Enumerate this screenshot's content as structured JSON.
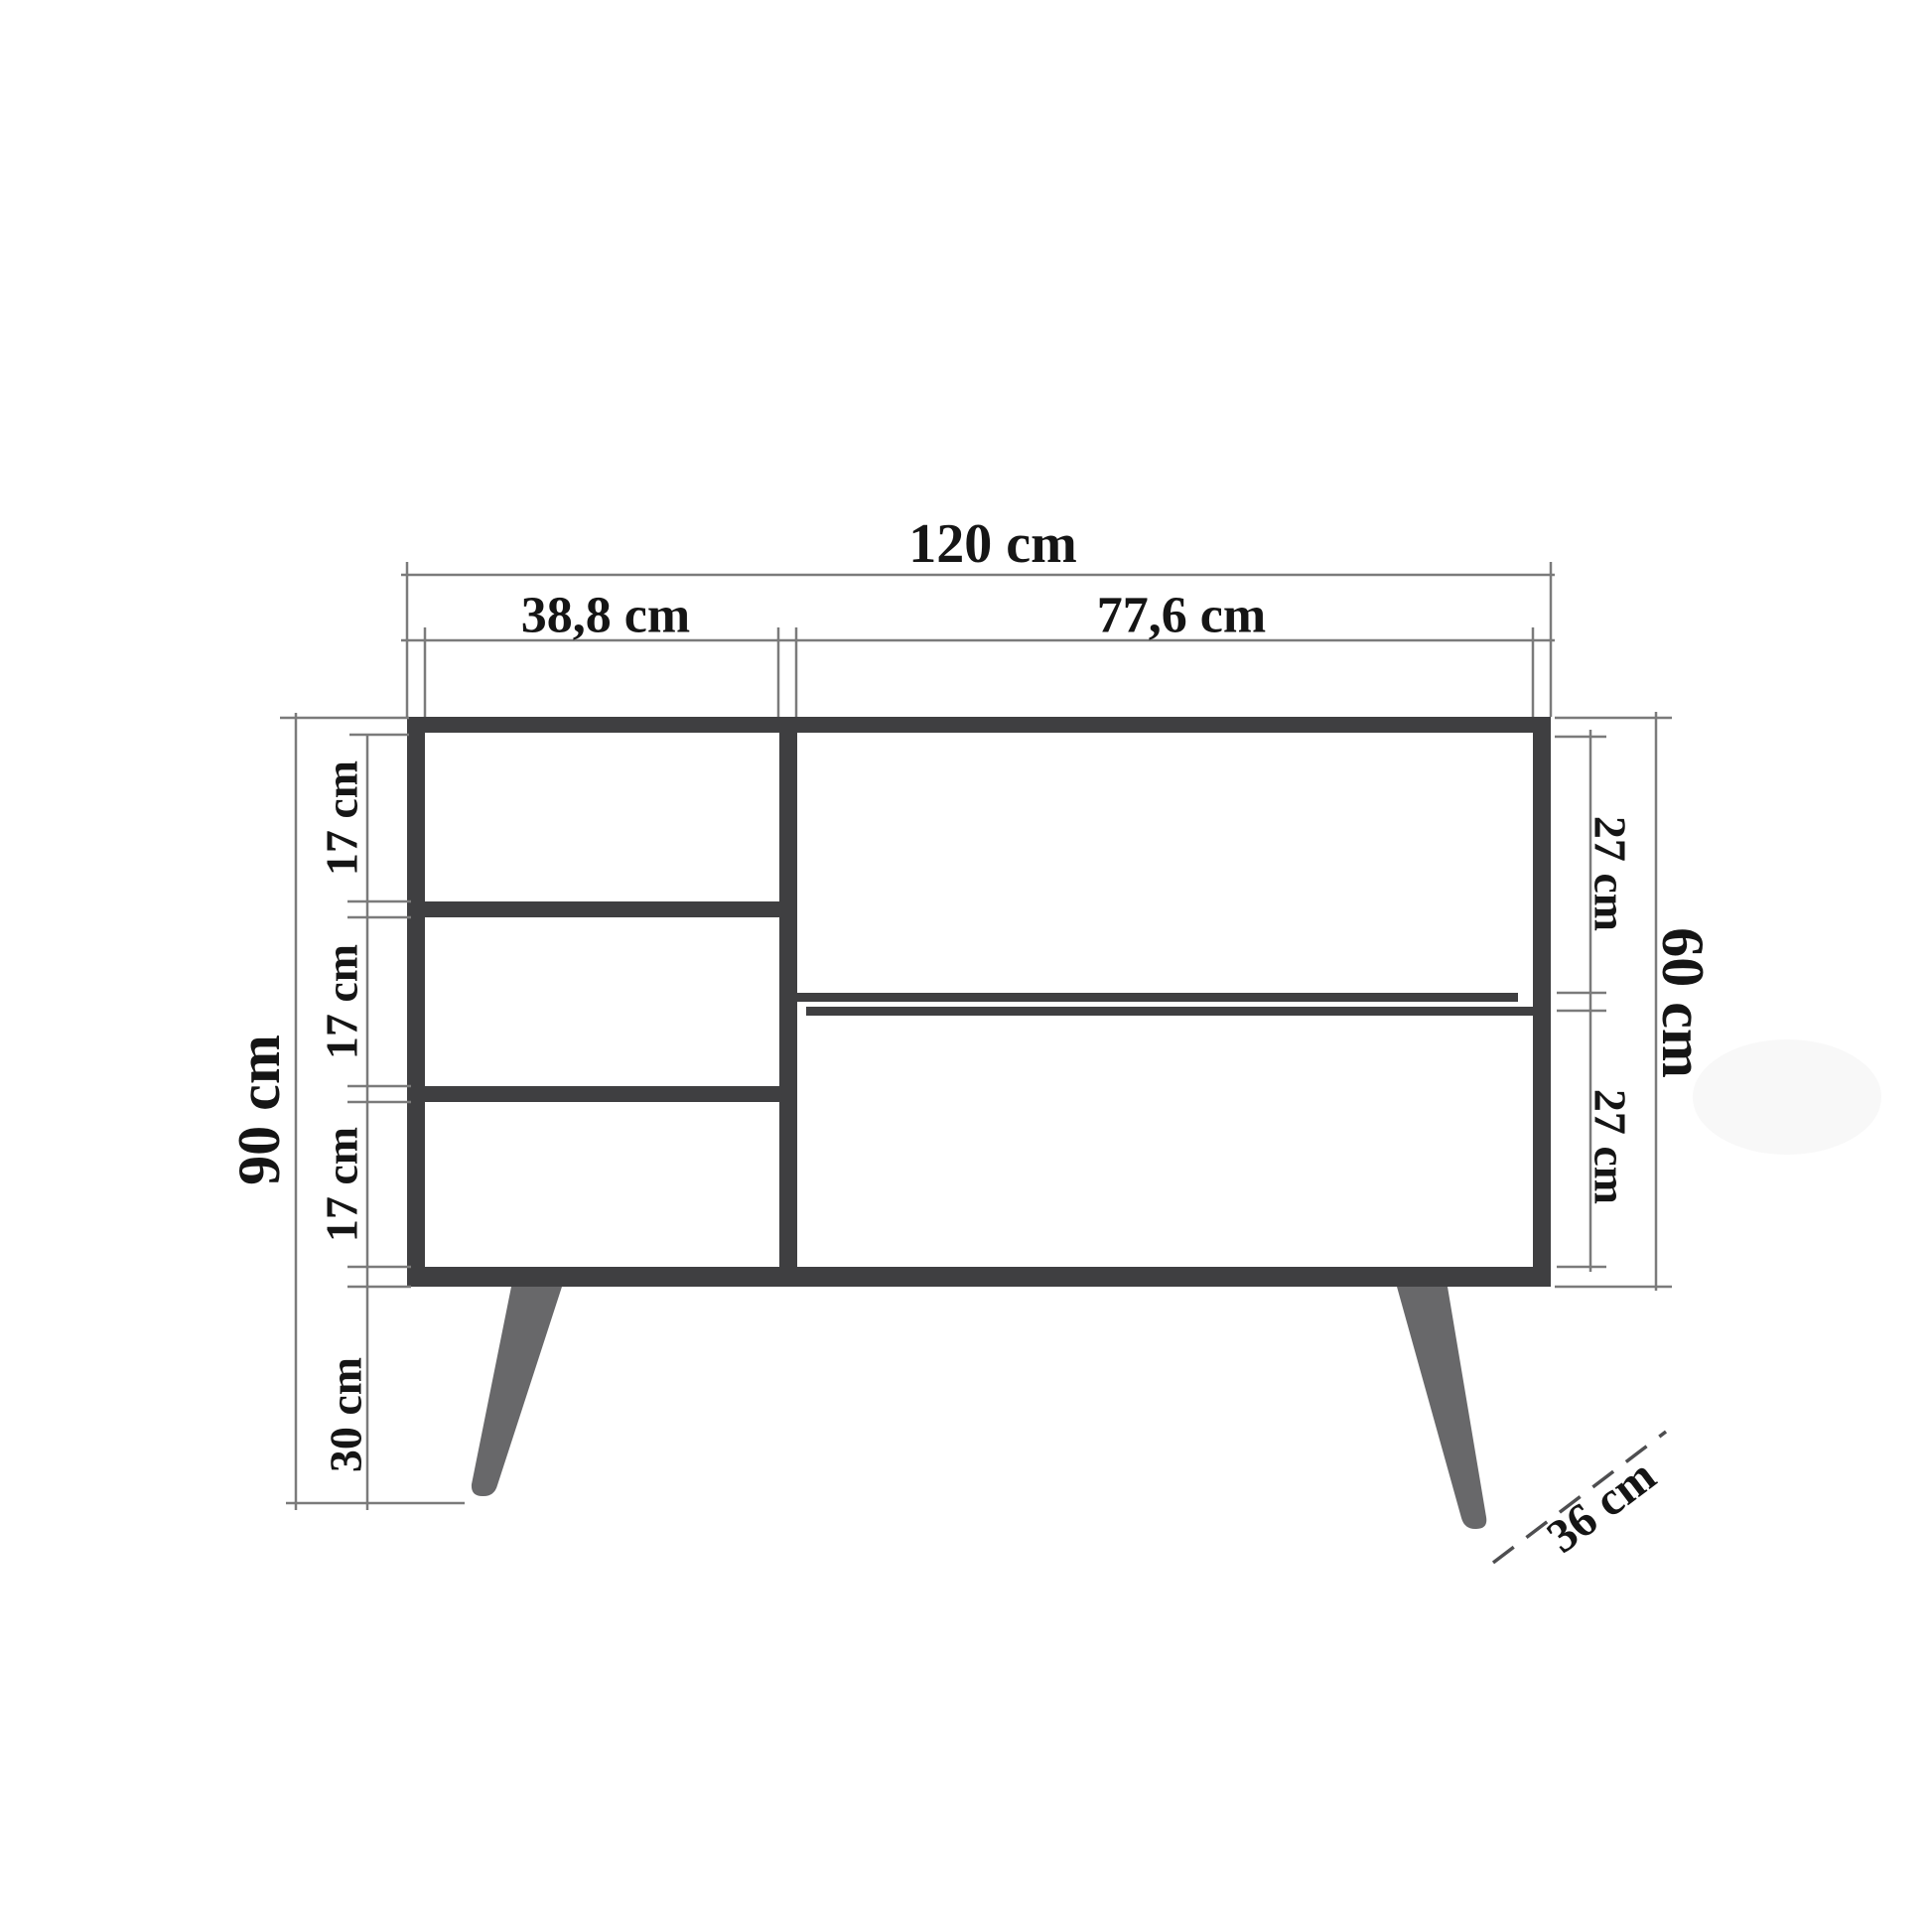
{
  "labels": {
    "total_width": "120 cm",
    "left_section_width": "38,8 cm",
    "right_section_width": "77,6 cm",
    "total_height": "90 cm",
    "drawer_1_height": "17 cm",
    "drawer_2_height": "17 cm",
    "drawer_3_height": "17 cm",
    "leg_height": "30 cm",
    "body_height": "60 cm",
    "right_upper_height": "27 cm",
    "right_lower_height": "27 cm",
    "depth": "36 cm"
  },
  "colors": {
    "background": "#ffffff",
    "frame": "#3f3f41",
    "legs": "#68686a",
    "dimension_lines": "#7b7b7b",
    "depth_dash": "#4e4e50",
    "text": "#151515",
    "artifact": "#f3f3f3"
  }
}
